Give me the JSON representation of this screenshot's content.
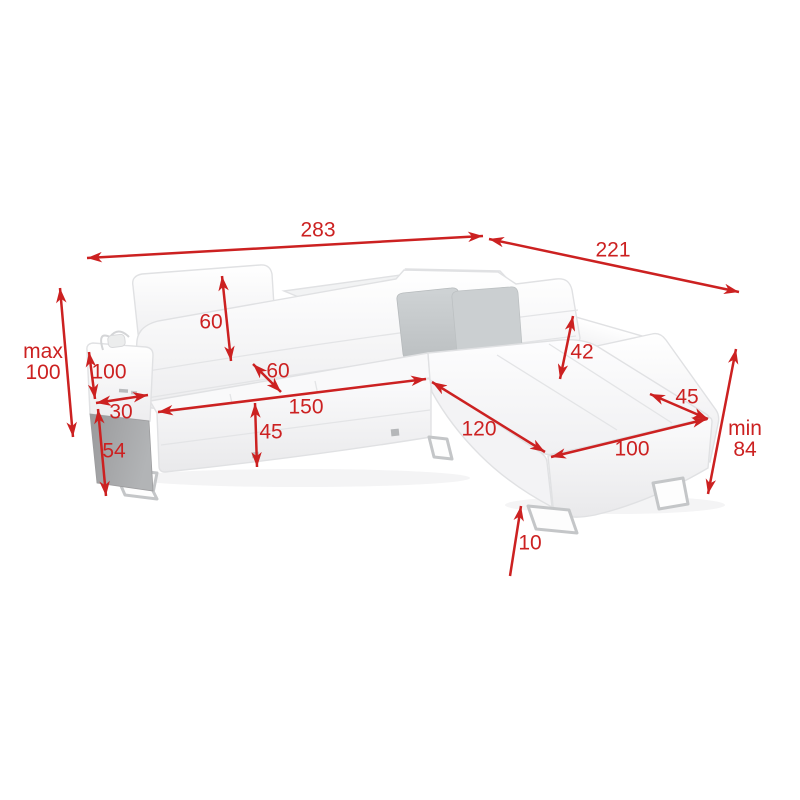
{
  "figure": {
    "type": "product-dimension-diagram",
    "subject": "corner-sofa-with-adjustable-headrests-and-side-shelf"
  },
  "colors": {
    "dimension": "#cc2121",
    "background": "#ffffff",
    "sofa_fill": "#fdfdfe",
    "sofa_shade": "#ededef",
    "sofa_stroke": "#e0e1e3",
    "pillow_front": "#c8ccce",
    "pillow_back": "#b2b6b8",
    "side_panel": "#a6a8aa",
    "leg": "#c4c6c8"
  },
  "dimensions": [
    {
      "id": "total-width",
      "lines": [
        "283"
      ],
      "x1": 87,
      "y1": 258,
      "x2": 483,
      "y2": 236,
      "lx": 318,
      "ly": 230,
      "heads": "both"
    },
    {
      "id": "total-depth",
      "lines": [
        "221"
      ],
      "x1": 489,
      "y1": 239,
      "x2": 739,
      "y2": 292,
      "lx": 613,
      "ly": 250,
      "heads": "both"
    },
    {
      "id": "height-max",
      "lines": [
        "max",
        "100"
      ],
      "x1": 60,
      "y1": 288,
      "x2": 73,
      "y2": 437,
      "lx": 43,
      "ly": 362,
      "heads": "both"
    },
    {
      "id": "armrest-height",
      "lines": [
        "100"
      ],
      "x1": 89,
      "y1": 352,
      "x2": 95,
      "y2": 399,
      "lx": 109,
      "ly": 372,
      "heads": "both"
    },
    {
      "id": "armrest-width",
      "lines": [
        "30"
      ],
      "x1": 96,
      "y1": 403,
      "x2": 148,
      "y2": 395,
      "lx": 121,
      "ly": 412,
      "heads": "both"
    },
    {
      "id": "side-panel-height",
      "lines": [
        "54"
      ],
      "x1": 98,
      "y1": 409,
      "x2": 106,
      "y2": 496,
      "lx": 114,
      "ly": 451,
      "heads": "both"
    },
    {
      "id": "backrest-height",
      "lines": [
        "60"
      ],
      "x1": 222,
      "y1": 276,
      "x2": 231,
      "y2": 361,
      "lx": 211,
      "ly": 322,
      "heads": "both"
    },
    {
      "id": "seat-depth",
      "lines": [
        "60"
      ],
      "x1": 253,
      "y1": 364,
      "x2": 281,
      "y2": 392,
      "lx": 278,
      "ly": 371,
      "heads": "both"
    },
    {
      "id": "seat-width",
      "lines": [
        "150"
      ],
      "x1": 158,
      "y1": 412,
      "x2": 426,
      "y2": 379,
      "lx": 306,
      "ly": 407,
      "heads": "both"
    },
    {
      "id": "seat-height",
      "lines": [
        "45"
      ],
      "x1": 255,
      "y1": 403,
      "x2": 257,
      "y2": 467,
      "lx": 271,
      "ly": 432,
      "heads": "both"
    },
    {
      "id": "headrest-height",
      "lines": [
        "42"
      ],
      "x1": 573,
      "y1": 316,
      "x2": 560,
      "y2": 379,
      "lx": 582,
      "ly": 352,
      "heads": "both"
    },
    {
      "id": "right-armrest-width",
      "lines": [
        "45"
      ],
      "x1": 650,
      "y1": 394,
      "x2": 708,
      "y2": 419,
      "lx": 687,
      "ly": 397,
      "heads": "both"
    },
    {
      "id": "chaise-length",
      "lines": [
        "120"
      ],
      "x1": 432,
      "y1": 382,
      "x2": 545,
      "y2": 452,
      "lx": 479,
      "ly": 429,
      "heads": "both"
    },
    {
      "id": "chaise-width",
      "lines": [
        "100"
      ],
      "x1": 551,
      "y1": 457,
      "x2": 707,
      "y2": 419,
      "lx": 632,
      "ly": 449,
      "heads": "both"
    },
    {
      "id": "height-min",
      "lines": [
        "min",
        "84"
      ],
      "x1": 736,
      "y1": 349,
      "x2": 708,
      "y2": 494,
      "lx": 745,
      "ly": 439,
      "heads": "both"
    },
    {
      "id": "leg-height",
      "lines": [
        "10"
      ],
      "x1": 510,
      "y1": 576,
      "x2": 521,
      "y2": 506,
      "lx": 530,
      "ly": 543,
      "heads": "end"
    }
  ]
}
